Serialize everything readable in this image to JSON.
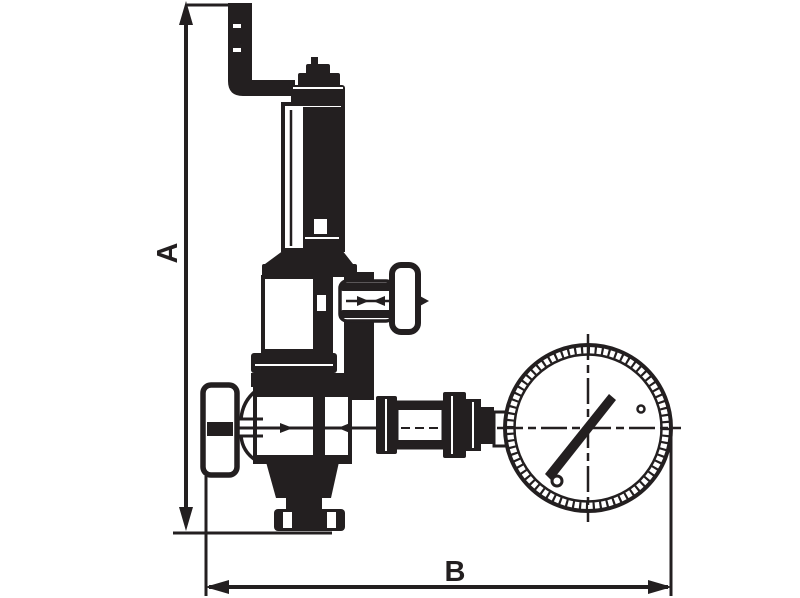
{
  "canvas": {
    "width": 800,
    "height": 598,
    "background": "#ffffff",
    "ink": "#231f20"
  },
  "labels": {
    "dim_vertical": "A",
    "dim_horizontal": "B"
  },
  "drawing": {
    "type": "technical dimension drawing",
    "subject": "pressure relief valve with discharge pipe and pressure gauge",
    "parts": [
      "discharge-pipe",
      "adjustment-cap",
      "spring-housing",
      "bell-housing",
      "side-drain-valve",
      "drain-handle",
      "mid-flange",
      "valve-body",
      "inlet-handwheel",
      "bottom-cone",
      "bottom-flange",
      "outlet-couplings",
      "pressure-gauge",
      "gauge-needle"
    ],
    "dimension_a": "overall height from discharge pipe top to outlet flange base",
    "dimension_b": "overall width from handwheel face to gauge rim"
  }
}
